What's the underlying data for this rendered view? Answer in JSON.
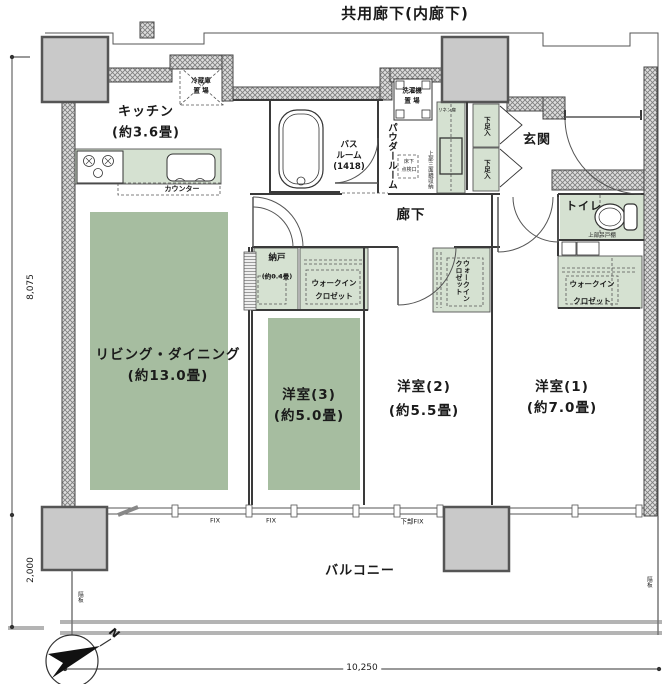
{
  "plan": {
    "common_corridor": "共用廊下(内廊下)",
    "corridor": "廊下",
    "balcony": "バルコニー",
    "genkan": "玄関",
    "toilet": "トイレ",
    "kitchen_name": "キッチン",
    "kitchen_size": "(約3.6畳)",
    "living_name": "リビング・ダイニング",
    "living_size": "(約13.0畳)",
    "room3_name": "洋室(3)",
    "room3_size": "(約5.0畳)",
    "room2_name": "洋室(2)",
    "room2_size": "(約5.5畳)",
    "room1_name": "洋室(1)",
    "room1_size": "(約7.0畳)",
    "nando_name": "納戸",
    "nando_size": "(約0.4畳)",
    "bath_1": "バス",
    "bath_2": "ルーム",
    "bath_3": "(1418)",
    "powder": "パウダールーム"
  },
  "fixtures": {
    "fridge_1": "冷蔵庫",
    "fridge_2": "置 場",
    "counter": "カウンター",
    "washer_1": "洗濯機",
    "washer_2": "置 場",
    "linen": "リネン庫",
    "shoe": "下足入",
    "mirror": "上部三面鏡収納",
    "hatch_1": "床下",
    "hatch_2": "点検口",
    "cupboard": "上部吊戸棚",
    "wic_1": "ウォークイン",
    "wic_2": "クロゼット",
    "partition": "隔板"
  },
  "windows": {
    "fix": "FIX",
    "lower_fix": "下部FIX"
  },
  "dimensions": {
    "height_main": "8,075",
    "height_balcony": "2,000",
    "width": "10,250"
  },
  "compass": {
    "label": "N"
  },
  "colors": {
    "room_green": "#a6bda0",
    "light_green": "#d5e1d1",
    "pillar_gray": "#c9c9c9",
    "wall_hatch": "#808080",
    "line": "#3a3a3a"
  }
}
